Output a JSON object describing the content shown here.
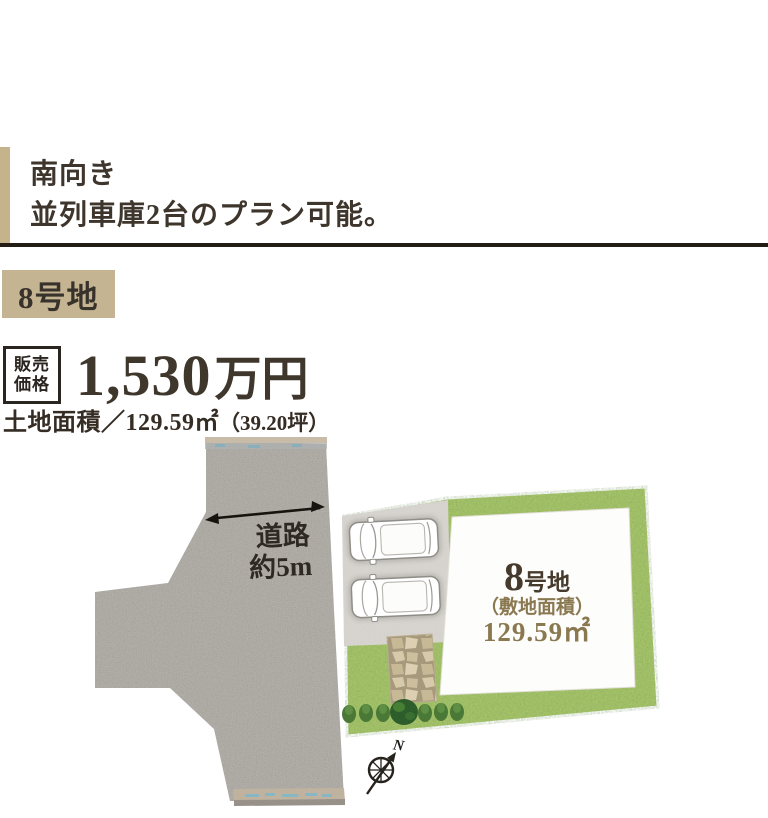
{
  "headline": {
    "line1": "南向き",
    "line2": "並列車庫2台のプラン可能。"
  },
  "lot_badge": {
    "label": "8号地"
  },
  "price": {
    "label_top": "販売",
    "label_bottom": "価格",
    "amount": "1,530",
    "unit": "万円"
  },
  "land_area": {
    "main": "土地面積／129.59㎡",
    "tsubo": "（39.20坪）"
  },
  "site_plan": {
    "road_label": {
      "line1": "道路",
      "line2": "約5m"
    },
    "lot_label": {
      "number": "8",
      "suffix": "号地",
      "caption": "（敷地面積）",
      "area": "129.59㎡"
    },
    "compass": {
      "north": "N"
    }
  },
  "colors": {
    "accent_tan": "#c5b38c",
    "badge_tan": "#c5b491",
    "dark_rule": "#241d16",
    "text_dark": "#3e352c",
    "lot_gold": "#8a7851",
    "road_gray": "#b4b0aa",
    "parking_pad_gray": "#dad7d2",
    "lawn_green": "#a9c56a",
    "stone_beige": "#cdbf9e",
    "bush_green": "#4a7836"
  }
}
